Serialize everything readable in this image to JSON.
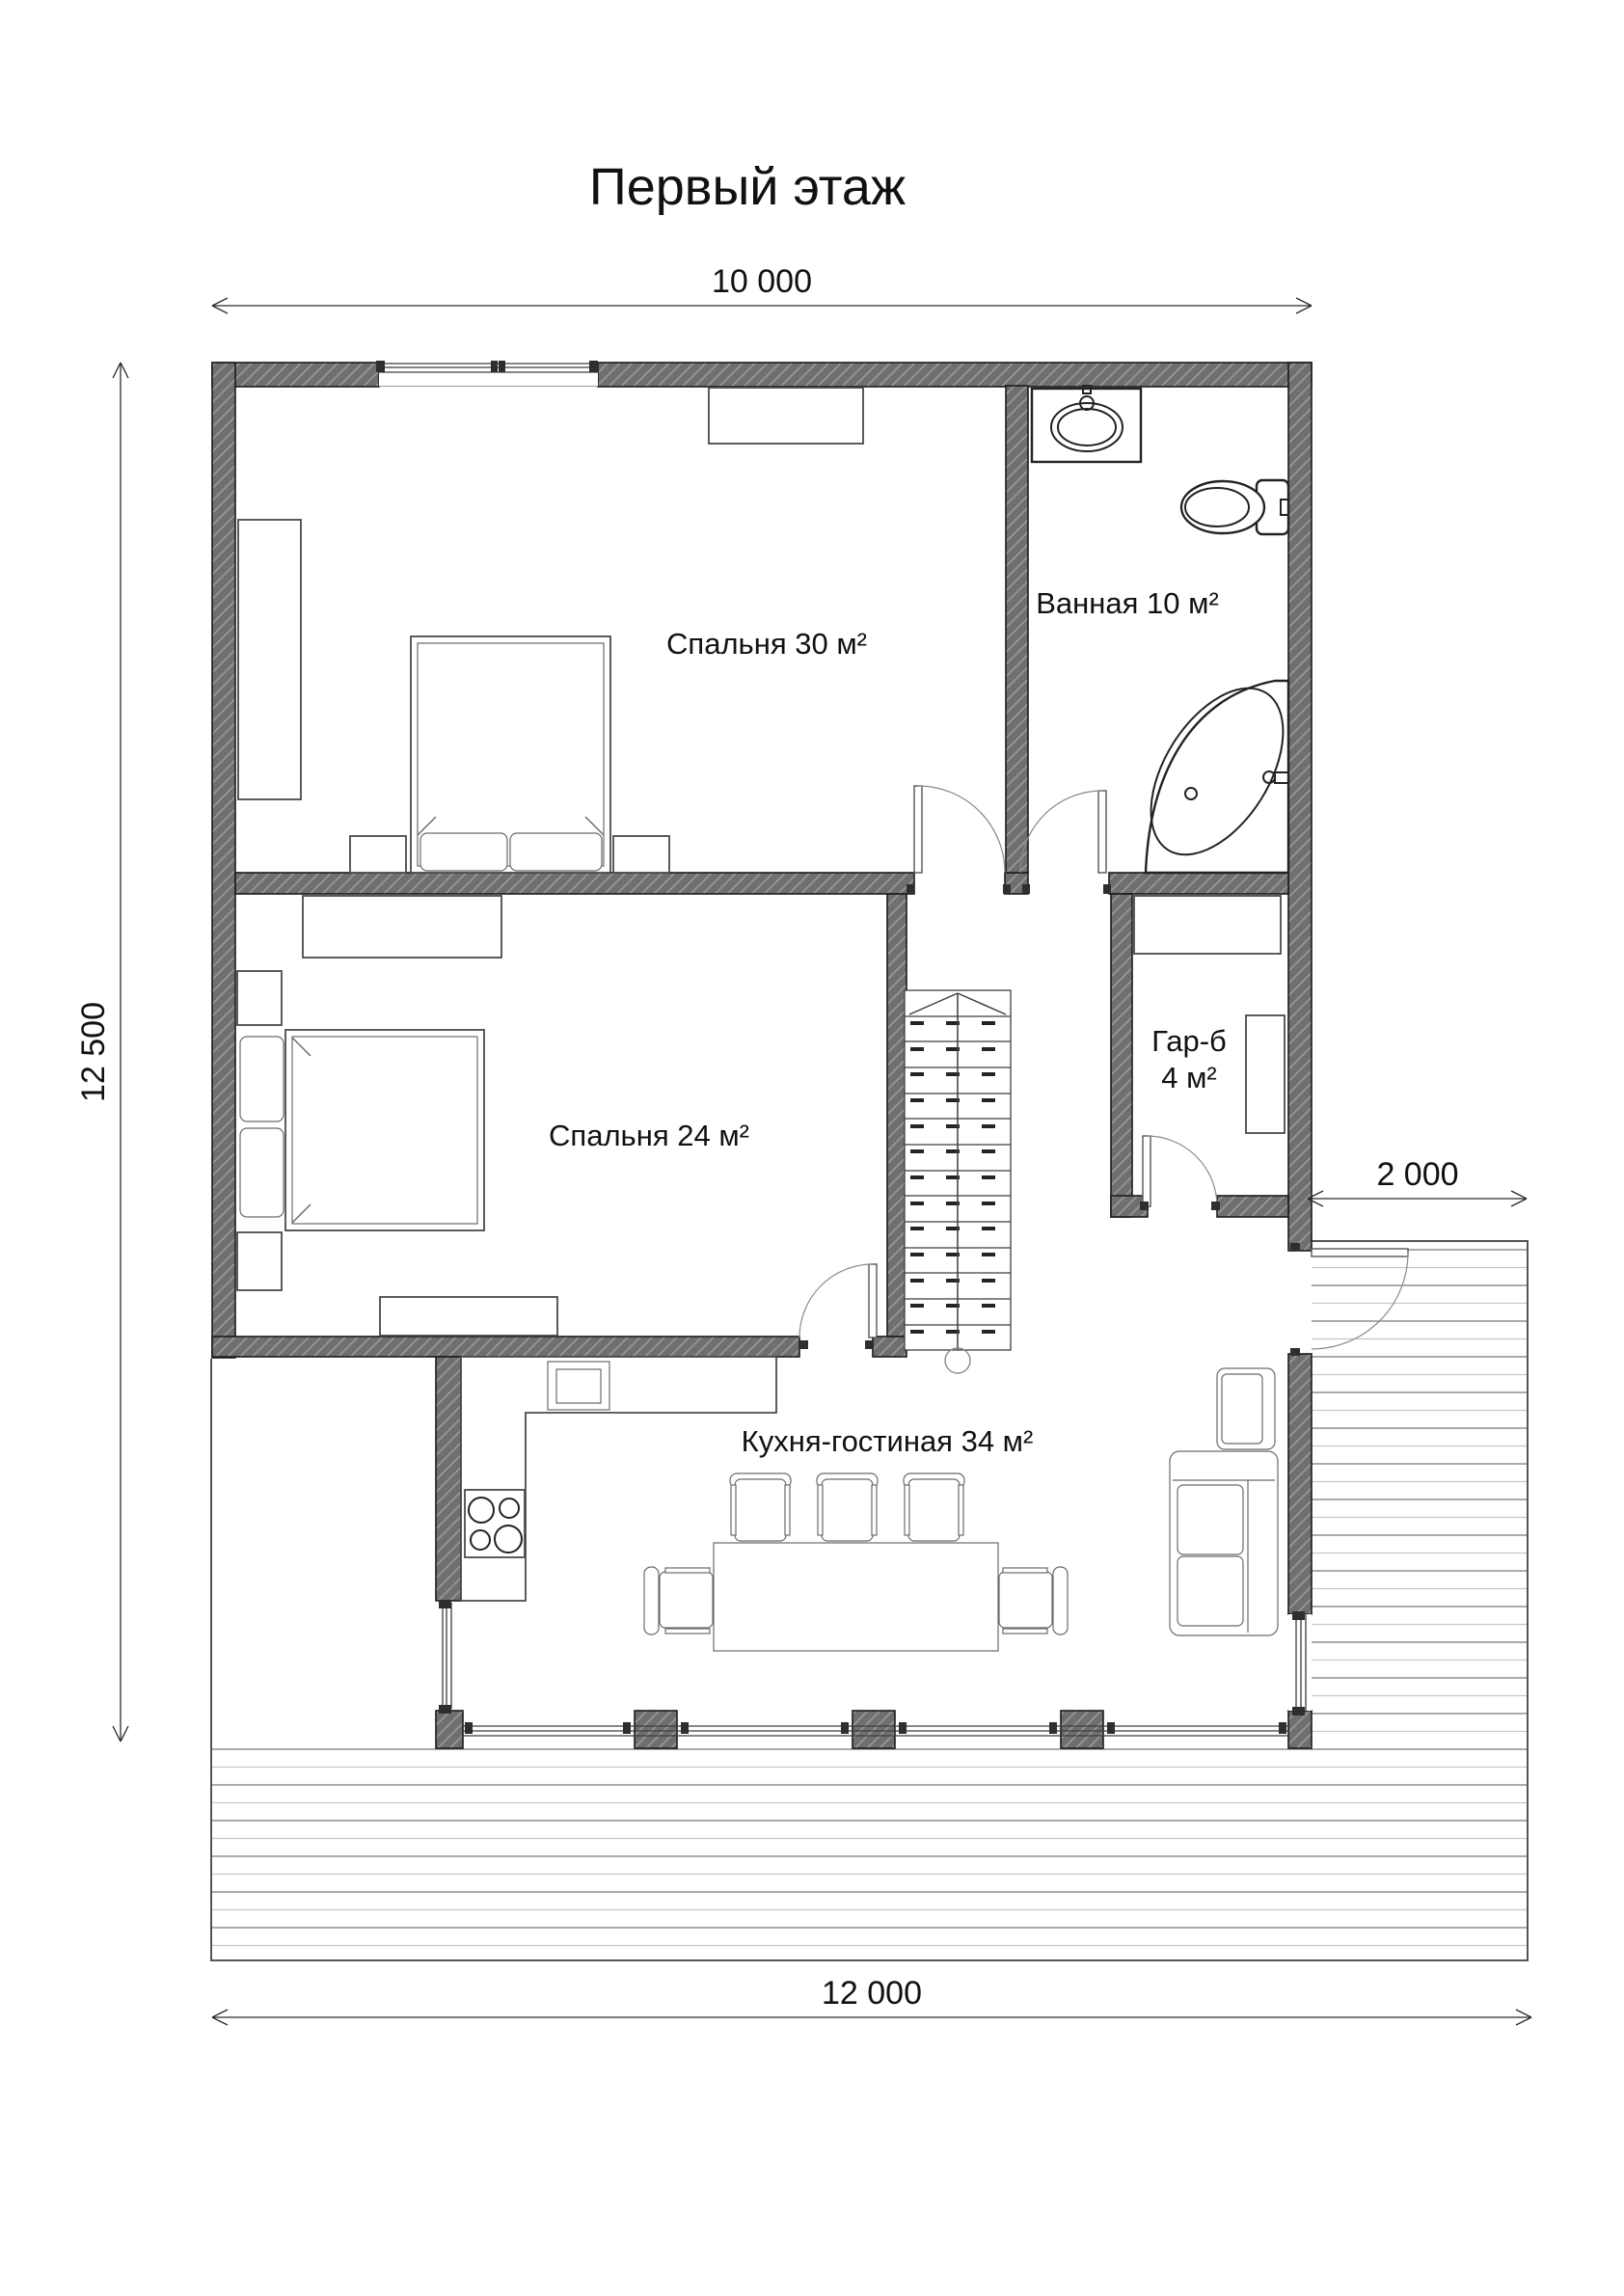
{
  "title": "Первый этаж",
  "dimensions": {
    "top": "10 000",
    "left": "12 500",
    "right": "2 000",
    "bottom": "12 000"
  },
  "rooms": {
    "bedroom30": "Спальня 30 м²",
    "bathroom": "Ванная 10 м²",
    "bedroom24": "Спальня 24 м²",
    "wardrobe_line1": "Гар-б",
    "wardrobe_line2": "4 м²",
    "kitchen": "Кухня-гостиная 34 м²"
  },
  "colors": {
    "wall": "#6f6f6f",
    "hatch": "#989898",
    "line": "#1c1c1c",
    "furn": "#4a4a4a",
    "deck-dark": "#8f8f8f",
    "deck-light": "#c6c6c6",
    "dim": "#2b2b2b",
    "text": "#111111"
  }
}
